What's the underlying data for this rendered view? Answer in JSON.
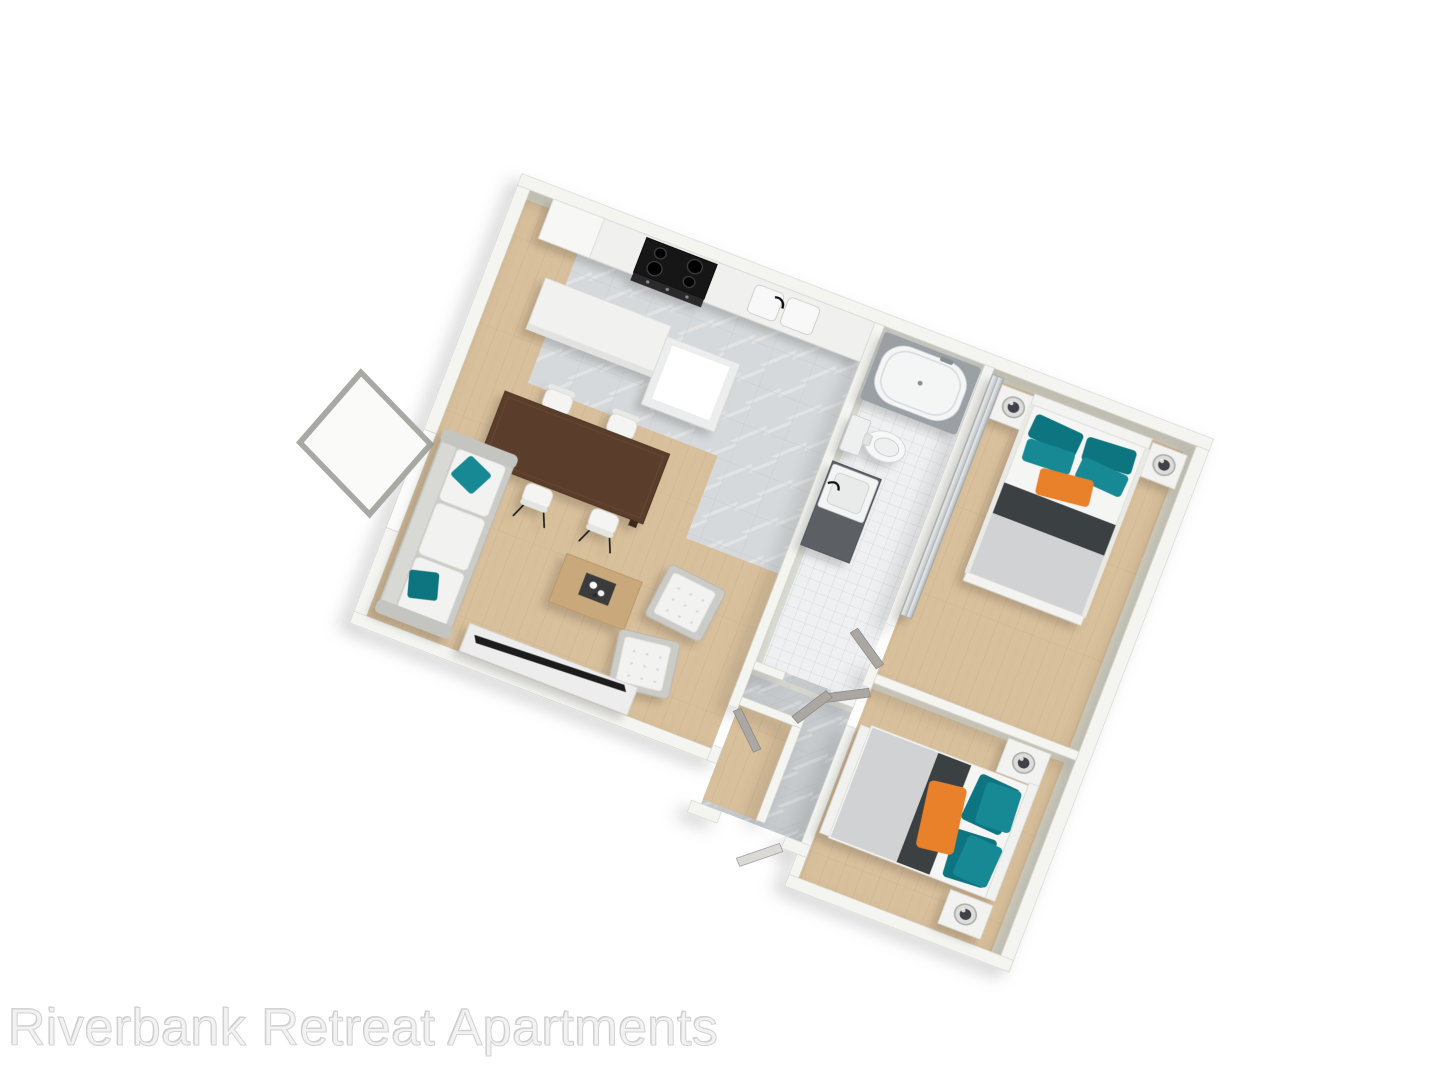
{
  "watermark": {
    "text": "Riverbank Retreat Apartments"
  },
  "colors": {
    "background": "#ffffff",
    "wall": "#f4f4f1",
    "wall_face": "#d7d9cf",
    "floor_wood": "#d9c09c",
    "floor_marble": "#c6cacd",
    "floor_tile": "#eef0f1",
    "kitchen_marble": "#d6d9db",
    "accent_teal": "#188994",
    "accent_teal_dark": "#0e7480",
    "accent_orange": "#e8812a",
    "blanket_dark": "#3b3f43",
    "blanket_light": "#d1d2d3",
    "bedding_white": "#f5f5f3",
    "dining_wood": "#5a3e2c",
    "coffee_wood": "#c9a97c",
    "door_gray": "#aba7a3",
    "tub_surround": "#9aa0a4",
    "watermark": "#f2f2f2"
  }
}
